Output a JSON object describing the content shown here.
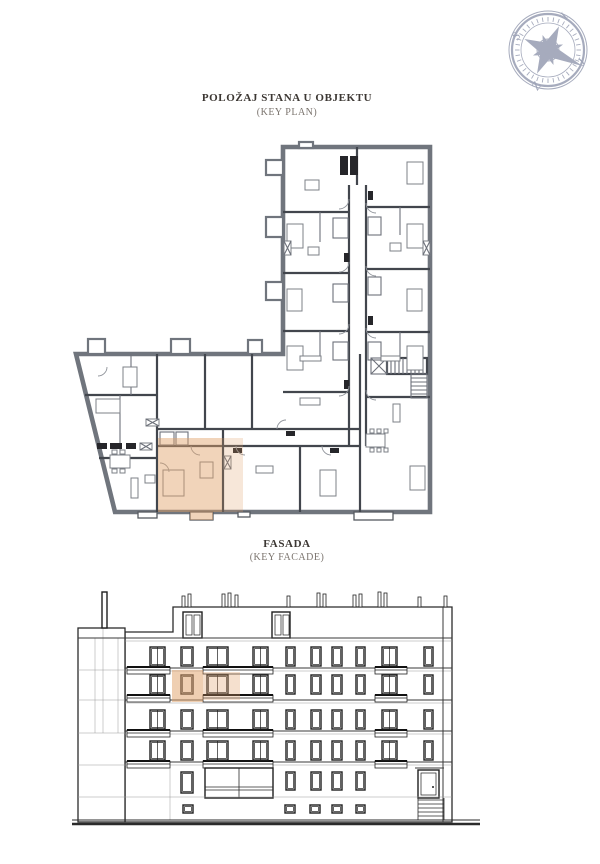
{
  "key_plan": {
    "title": "POLOŽAJ STANA U OBJEKTU",
    "subtitle": "(KEY PLAN)"
  },
  "facade": {
    "title": "FASADA",
    "subtitle": "(KEY FACADE)"
  },
  "compass": {
    "letters": {
      "top": "I",
      "right": "J",
      "bottom": "Z",
      "left": "S"
    },
    "color": "#a6abbd"
  },
  "highlight": {
    "color": "#dfa066",
    "plan_opacity": "0.45",
    "plan_light_opacity": "0.25",
    "facade_opacity": "0.5",
    "facade_light_opacity": "0.32"
  },
  "colors": {
    "plan_exterior_wall": "#70757d",
    "plan_interior_wall": "#42464d",
    "facade_line": "#2b2b2b",
    "title_text": "#3c3733",
    "subtitle_text": "#7b746e",
    "page_background": "#ffffff"
  }
}
